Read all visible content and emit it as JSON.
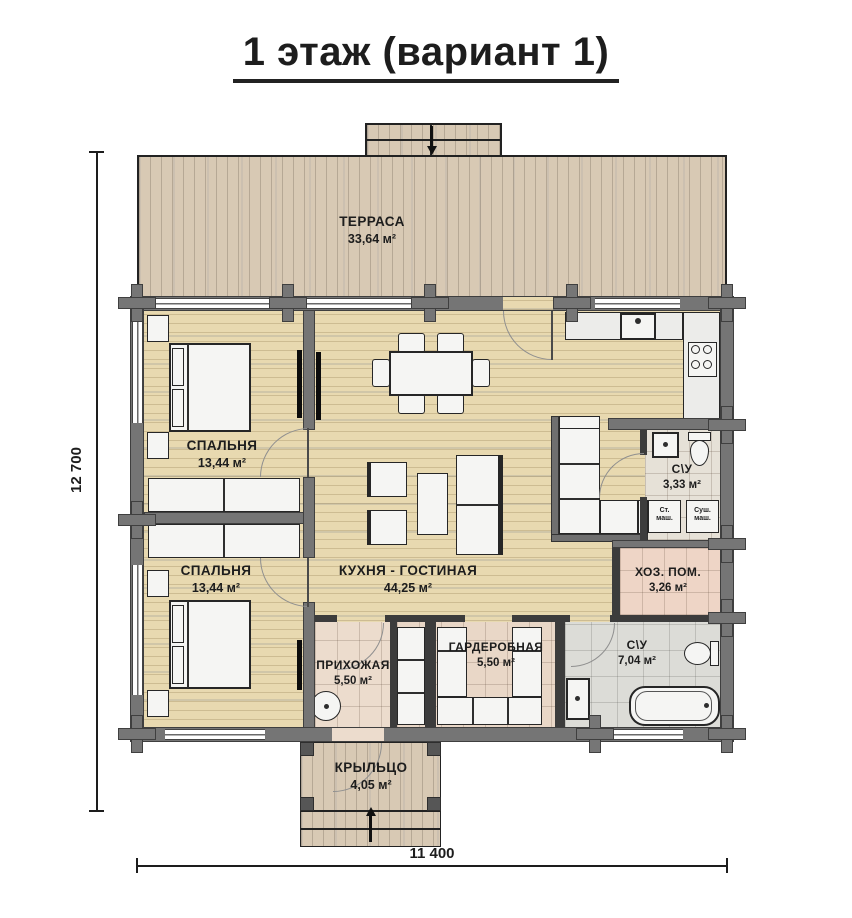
{
  "title": "1 этаж (вариант 1)",
  "dimensions": {
    "left": "12 700",
    "bottom": "11 400"
  },
  "rooms": {
    "terrace": {
      "name": "ТЕРРАСА",
      "area": "33,64 м²"
    },
    "bedroom_top": {
      "name": "СПАЛЬНЯ",
      "area": "13,44 м²"
    },
    "bedroom_bottom": {
      "name": "СПАЛЬНЯ",
      "area": "13,44 м²"
    },
    "kitchen_living": {
      "name": "КУХНЯ - ГОСТИНАЯ",
      "area": "44,25 м²"
    },
    "bathroom_small": {
      "name": "С\\У",
      "area": "3,33 м²"
    },
    "utility": {
      "name": "ХОЗ. ПОМ.",
      "area": "3,26 м²"
    },
    "hallway": {
      "name": "ПРИХОЖАЯ",
      "area": "5,50 м²"
    },
    "wardrobe": {
      "name": "ГАРДЕРОБНАЯ",
      "area": "5,50 м²"
    },
    "bathroom_big": {
      "name": "С\\У",
      "area": "7,04 м²"
    },
    "porch": {
      "name": "КРЫЛЬЦО",
      "area": "4,05 м²"
    }
  },
  "appliances": {
    "washer": "Ст.\nмаш.",
    "dryer": "Суш.\nмаш."
  },
  "colors": {
    "exterior_wall": "#757575",
    "interior_wall": "#3c3c3c",
    "interior_wood": "#e8d9b0",
    "terrace_wood": "#d8c9b4",
    "hall_tile": "#ecdccd",
    "utility_tile": "#eed5c6",
    "bath_small_tile": "#e6e1d7",
    "bath_big_tile": "#dcdcd7",
    "line": "#1d1d1d"
  }
}
